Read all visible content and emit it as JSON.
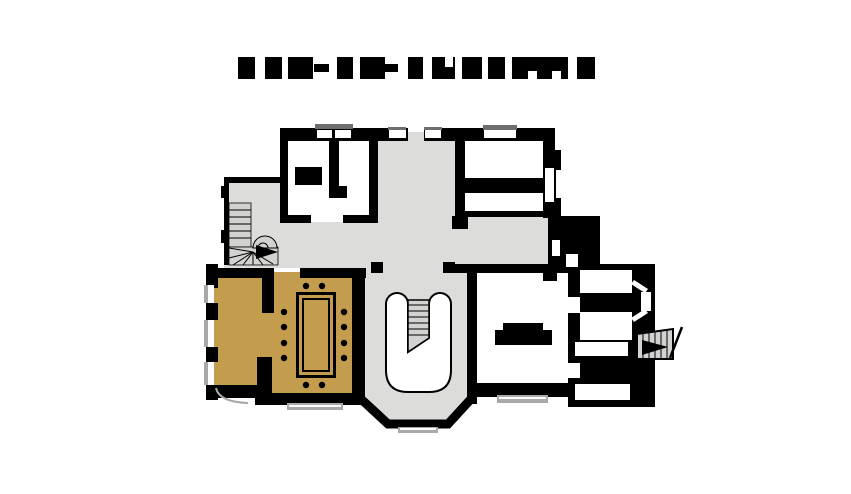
{
  "title": {
    "kind": "redacted-text",
    "block_top": 57,
    "block_height": 22,
    "dash_top": 64,
    "dash_height": 8,
    "blocks": [
      {
        "x": 238,
        "w": 17,
        "type": "full"
      },
      {
        "x": 265,
        "w": 17,
        "type": "full"
      },
      {
        "x": 288,
        "w": 25,
        "type": "full"
      },
      {
        "x": 314,
        "w": 15,
        "type": "dash"
      },
      {
        "x": 337,
        "w": 16,
        "type": "full"
      },
      {
        "x": 360,
        "w": 25,
        "type": "full"
      },
      {
        "x": 385,
        "w": 13,
        "type": "dash"
      },
      {
        "x": 408,
        "w": 15,
        "type": "full"
      },
      {
        "x": 432,
        "w": 23,
        "type": "notch-top"
      },
      {
        "x": 462,
        "w": 20,
        "type": "full"
      },
      {
        "x": 488,
        "w": 17,
        "type": "full"
      },
      {
        "x": 512,
        "w": 56,
        "type": "notch-bottom-2"
      },
      {
        "x": 577,
        "w": 18,
        "type": "full"
      }
    ]
  },
  "colors": {
    "background": "#ffffff",
    "wall": "#000000",
    "hall_floor": "#dcdcda",
    "room_floor": "#ffffff",
    "dining_floor": "#c49c4e",
    "stair_tread": "#d2d2d0",
    "window_sill": "#a9a9a9",
    "window_cap": "#6e6e6e"
  },
  "plan": {
    "type": "floor-plan",
    "features": [
      "winder-staircase-with-up-arrow",
      "grand-u-staircase",
      "dining-room-with-table-and-12-chairs",
      "fireplace",
      "exterior-steps-with-arrow",
      "bay-windows"
    ]
  }
}
